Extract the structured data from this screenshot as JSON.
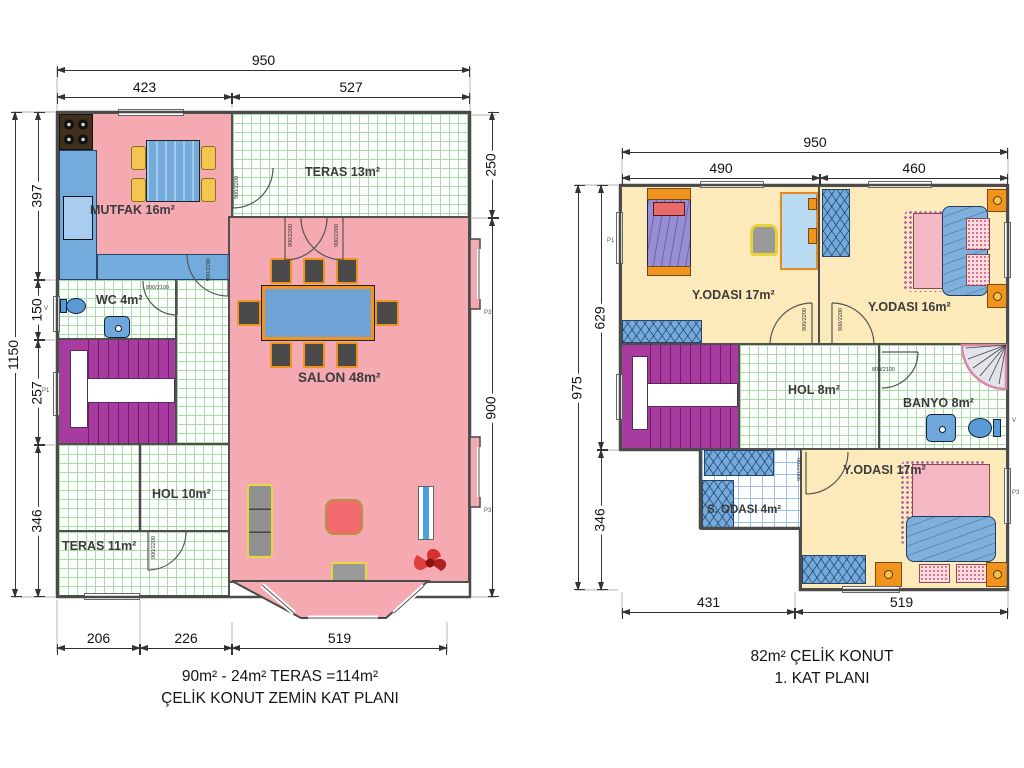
{
  "left_plan": {
    "caption_area": "90m² - 24m² TERAS  =114m²",
    "caption_title": "ÇELİK KONUT  ZEMİN KAT PLANI",
    "rooms": {
      "mutfak": "MUTFAK 16m²",
      "teras_ust": "TERAS 13m²",
      "wc": "WC 4m²",
      "salon": "SALON 48m²",
      "hol": "HOL 10m²",
      "teras_alt": "TERAS 11m²"
    },
    "dims": {
      "top_total": "950",
      "top_a": "423",
      "top_b": "527",
      "left_total": "1150",
      "left_a": "397",
      "left_b": "150",
      "left_c": "257",
      "left_d": "346",
      "right_a": "250",
      "right_b": "900",
      "bottom_a": "206",
      "bottom_b": "226",
      "bottom_c": "519"
    }
  },
  "right_plan": {
    "caption_area": "82m² ÇELİK KONUT",
    "caption_title": "1. KAT PLANI",
    "rooms": {
      "yatak1": "Y.ODASI 17m²",
      "yatak2": "Y.ODASI 16m²",
      "hol": "HOL 8m²",
      "banyo": "BANYO 8m²",
      "sandik": "S. ODASI 4m²",
      "yatak3": "Y.ODASI 17m²"
    },
    "dims": {
      "top_total": "950",
      "top_a": "490",
      "top_b": "460",
      "left_total": "975",
      "left_a": "629",
      "left_b": "346",
      "bottom_a": "431",
      "bottom_b": "519"
    }
  },
  "door_specs": {
    "standard": "900/2200",
    "small": "800/2100"
  },
  "window_tags": {
    "p1": "P1",
    "p3": "P3",
    "v": "V"
  }
}
